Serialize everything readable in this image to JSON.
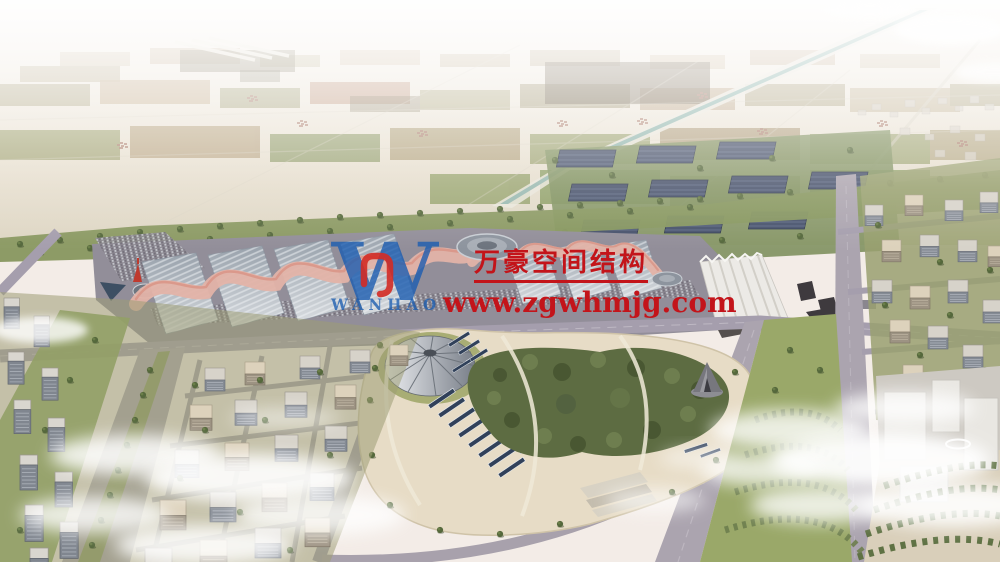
{
  "watermark": {
    "monogram": "W",
    "wordmark": "WANHAO",
    "company_name": "万豪空间结构",
    "website_url": "www.zgwhmjg.com",
    "text_red": "#c3141a",
    "logo_blue": "#1b5cb0",
    "logo_red_mark": "#d32b25"
  },
  "palette": {
    "sky_haze": "#f3ece7",
    "farmland": "#c7bda3",
    "canal_water": "#8fb5ad",
    "hall_roof_gray": "#aab2bb",
    "hall_canopy_pink": "#e2b0a5",
    "road_gray": "#a8a1ac",
    "park_ground_tan": "#e6dbc4",
    "foliage_green": "#55683c",
    "solar_panel_navy": "#31415a",
    "building_face": "#858b94",
    "cloud_white": "#ffffff"
  }
}
